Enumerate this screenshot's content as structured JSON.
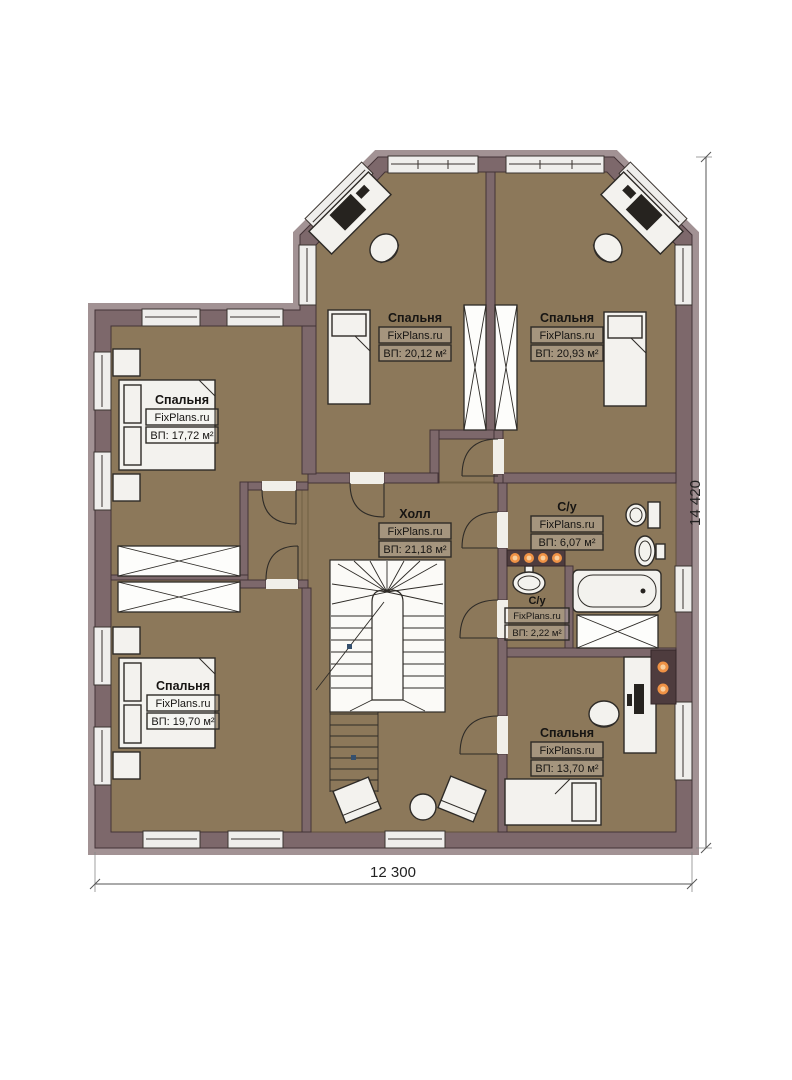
{
  "plan": {
    "rooms": [
      {
        "id": "bedroom-top-left",
        "name": "Спальня",
        "brand": "FixPlans.ru",
        "area": "ВП: 20,12 м²"
      },
      {
        "id": "bedroom-top-right",
        "name": "Спальня",
        "brand": "FixPlans.ru",
        "area": "ВП: 20,93 м²"
      },
      {
        "id": "bedroom-left",
        "name": "Спальня",
        "brand": "FixPlans.ru",
        "area": "ВП: 17,72 м²"
      },
      {
        "id": "hall",
        "name": "Холл",
        "brand": "FixPlans.ru",
        "area": "ВП: 21,18 м²"
      },
      {
        "id": "bathroom",
        "name": "С/у",
        "brand": "FixPlans.ru",
        "area": "ВП: 6,07 м²"
      },
      {
        "id": "wc-small",
        "name": "С/у",
        "brand": "FixPlans.ru",
        "area": "ВП: 2,22 м²"
      },
      {
        "id": "bedroom-bottom-left",
        "name": "Спальня",
        "brand": "FixPlans.ru",
        "area": "ВП: 19,70 м²"
      },
      {
        "id": "bedroom-bottom-right",
        "name": "Спальня",
        "brand": "FixPlans.ru",
        "area": "ВП: 13,70 м²"
      }
    ],
    "dimensions": {
      "width": "12 300",
      "height": "14 420"
    },
    "colors": {
      "wall": "#7d686b",
      "wall_outline": "#443337",
      "wood_floor": "#8c785a",
      "hall_tile": "#c6b189",
      "bath_tile": "#aedcf2",
      "bath_grid": "#5b9bd5",
      "furniture": "#f3f2ee",
      "light_accent": "#ef9245"
    }
  }
}
